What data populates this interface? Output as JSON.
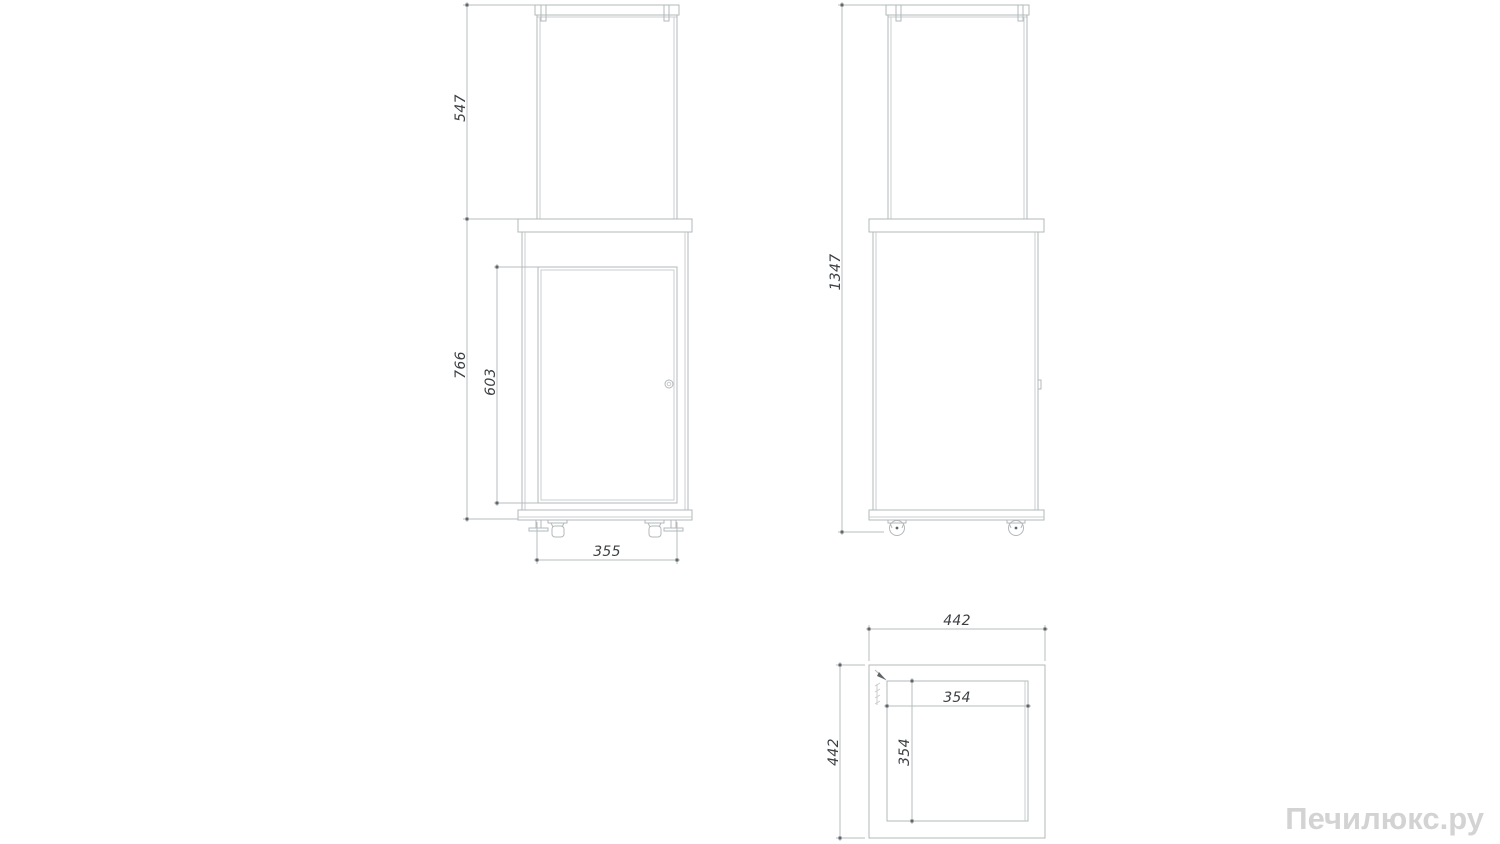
{
  "drawing": {
    "type": "technical-dimension-drawing",
    "watermark": "Печилюкс.ру",
    "front_view": {
      "dims": {
        "glass_section_height": "547",
        "body_height": "766",
        "door_height": "603",
        "body_width": "355"
      }
    },
    "side_view": {
      "dims": {
        "total_height": "1347"
      }
    },
    "top_view": {
      "dims": {
        "outer_width": "442",
        "outer_depth": "442",
        "inner_width": "354",
        "inner_depth": "354"
      }
    },
    "colors": {
      "line": "#b3b8bb",
      "dim_text": "#3c4043",
      "terminator": "#60656a",
      "watermark": "#d3d3d3",
      "background": "#ffffff"
    }
  }
}
